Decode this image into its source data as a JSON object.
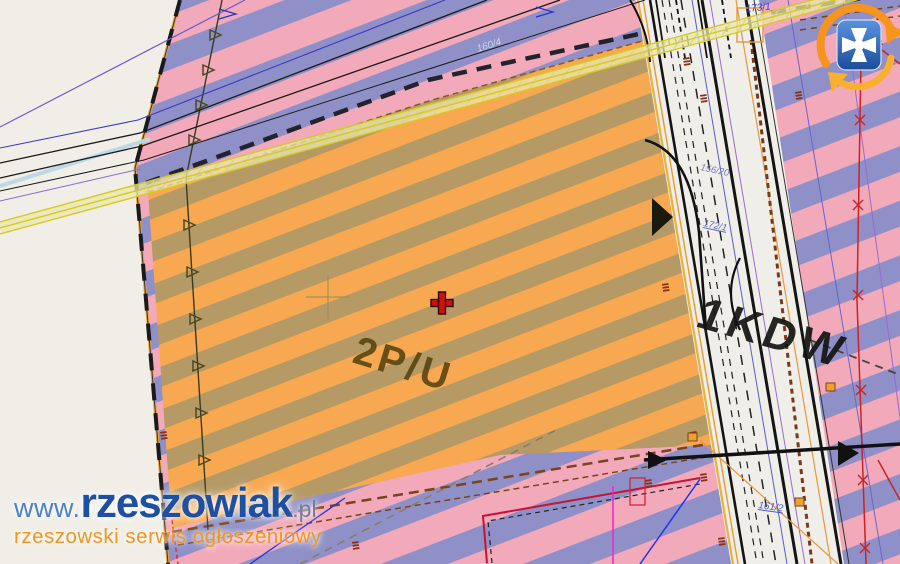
{
  "map": {
    "zones": {
      "industrial_label": "2P/U",
      "road_label": "1KDW"
    },
    "parcels": {
      "p173": "173/1",
      "p156": "156/20",
      "p172": "172/1",
      "p161": "161/2",
      "p160": "160/4"
    }
  },
  "watermark": {
    "www": "www.",
    "name": "rzeszowiak",
    "tld": ".pl",
    "tagline": "rzeszowski serwis ogłoszeniowy"
  },
  "colors": {
    "cream": "#F1EEE7",
    "pink": "#F2A9BA",
    "periwinkle": "#8F90C7",
    "orange": "#F8A850",
    "olive": "#B59A66",
    "road": "#F0EEE9",
    "red_cross": "#CC1111",
    "zone_text": "#55430F",
    "road_text": "#141414",
    "logo_blue": "#2A64B4",
    "logo_orange": "#F7941D"
  }
}
